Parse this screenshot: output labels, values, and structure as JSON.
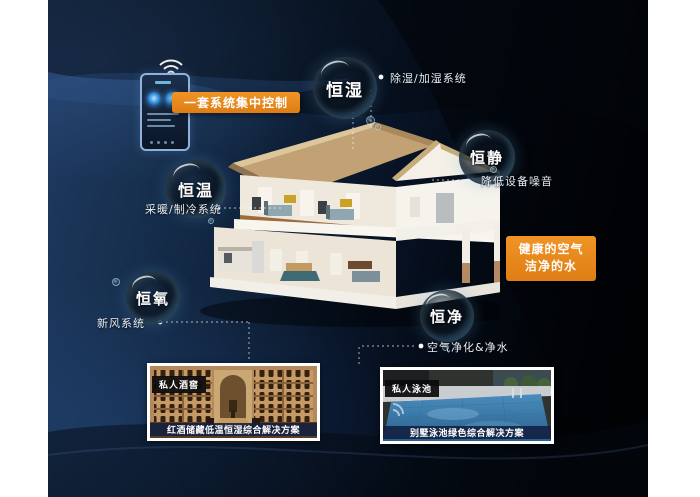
{
  "control": {
    "callout_label": "一套系统集中控制"
  },
  "bubbles": {
    "humidity": {
      "label": "恒湿",
      "desc": "除湿/加湿系统"
    },
    "quiet": {
      "label": "恒静",
      "desc": "降低设备噪音"
    },
    "temperature": {
      "label": "恒温",
      "desc": "采暖/制冷系统"
    },
    "oxygen": {
      "label": "恒氧",
      "desc": "新风系统"
    },
    "purity": {
      "label": "恒净",
      "desc": "空气净化&净水"
    }
  },
  "highlight_box": {
    "line1": "健康的空气",
    "line2": "洁净的水"
  },
  "cards": {
    "wine": {
      "tag": "私人酒窖",
      "caption": "红酒储藏低温恒湿综合解决方案"
    },
    "pool": {
      "tag": "私人泳池",
      "caption": "别墅泳池绿色综合解决方案"
    }
  },
  "colors": {
    "accent_orange": "#e8871b",
    "background_navy": "#16304f",
    "line_white": "#ffffff",
    "caption_band": "#122040"
  }
}
